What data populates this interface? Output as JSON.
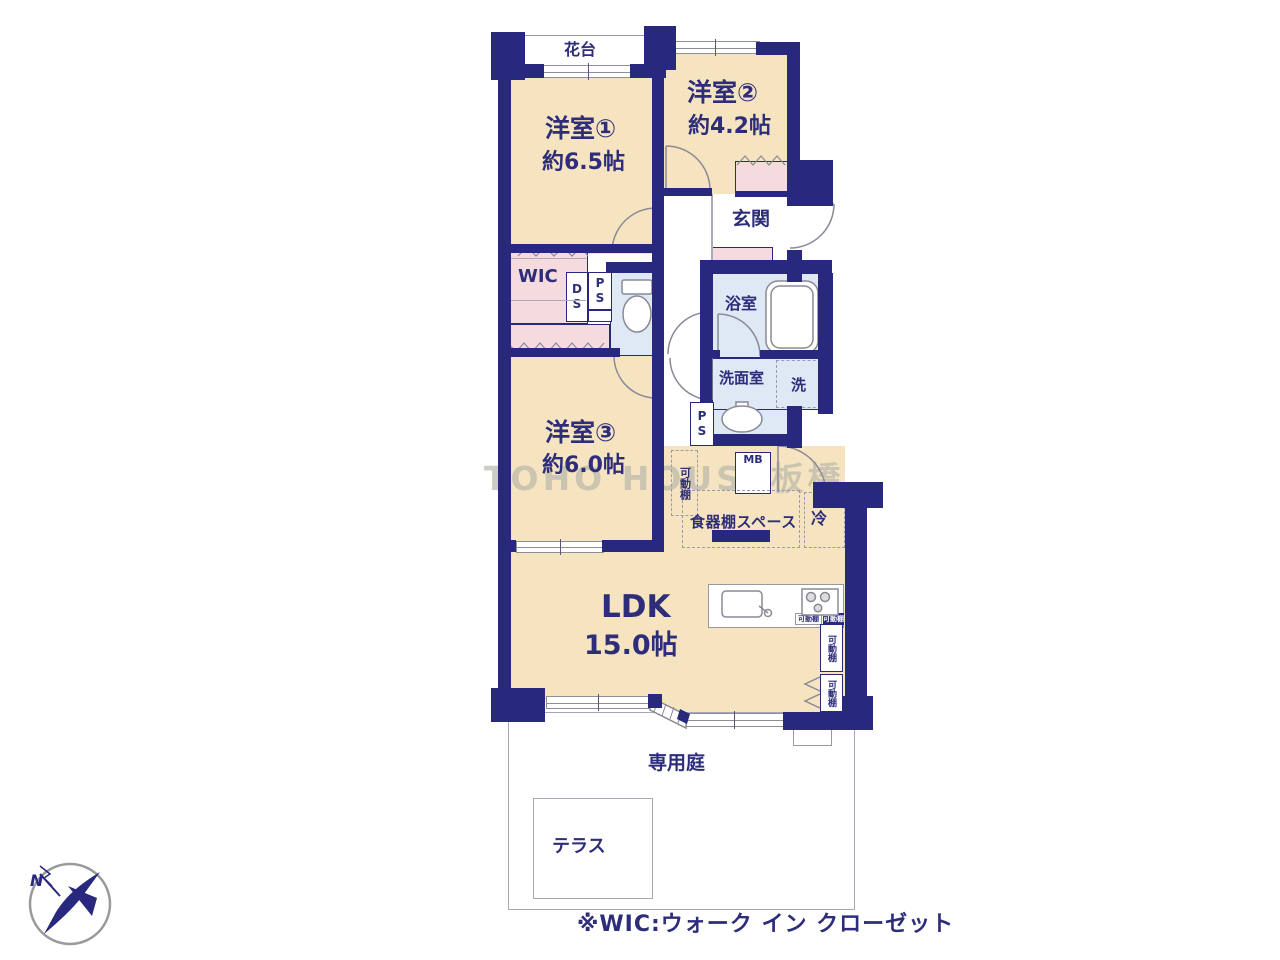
{
  "floorplan": {
    "watermark": "TOHO HOUSE板橋",
    "note": "※WIC:ウォーク イン クローゼット",
    "compass": {
      "north_label": "N"
    },
    "rooms": {
      "flower_stand": "花台",
      "bedroom1": {
        "name": "洋室①",
        "area": "約6.5帖"
      },
      "bedroom2": {
        "name": "洋室②",
        "area": "約4.2帖"
      },
      "bedroom3": {
        "name": "洋室③",
        "area": "約6.0帖"
      },
      "ldk": {
        "name": "LDK",
        "area": "15.0帖"
      },
      "entrance": "玄関",
      "walk_in_closet": "WIC",
      "bathroom": "浴室",
      "washroom": "洗面室",
      "private_garden": "専用庭",
      "terrace": "テラス"
    },
    "labels": {
      "duct_space": "DS",
      "pipe_space": "PS",
      "meter_box": "MB",
      "washer": "洗",
      "fridge": "冷",
      "dish_shelf_space": "食器棚スペース",
      "movable_shelf": "可動棚"
    },
    "colors": {
      "wall": "#28287E",
      "room_floor": "#F6E4C1",
      "closet": "#F5DBDE",
      "wet_area": "#DEE9F5",
      "outline": "#8E8E99",
      "text": "#2D2D7A"
    }
  }
}
